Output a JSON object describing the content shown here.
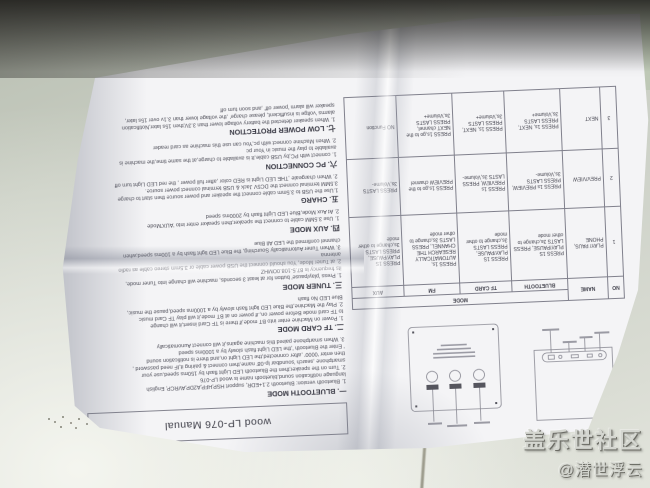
{
  "watermark": {
    "line1": "盖乐世社区",
    "line2": "@潜世浮云"
  },
  "manual": {
    "title": "wood LP-076 Manual",
    "sections": [
      {
        "heading": "一. BLUETOOTH MODE",
        "lines": [
          "1. Bluetooth version: Bluetooth 2.1+EDR, support HSP,HFP,A2DP,AVRCP, English",
          "language notification sound,bluetooth name is wood LP-076",
          "2. Turn on the speaker,then the Bluetooth LED Light flash by 150ms speed,use your",
          "smartphone ,search 'soundbar lp-08' name,then connect & pairing it,IF need password ,",
          "then enter '0000' ,after connected,the LED Light on,and there is notification sound",
          "' Enter the Bluetooth ',the LED Light flash slowly by a 1000ms speed",
          "3. When smartphone paired this machine agains,it will connect Aunomatically"
        ]
      },
      {
        "heading": "二. TF CARD MODE",
        "lines": [
          "1. Power on Machine enter into BT mode,if there is TF Card insert,it will change",
          "to TF card mode Before power on,.if power on at BT mode,it will play TF Card music",
          "2. Play the Machine,the Blue LED light flash slowly by a 1000ms speed,pause the music,",
          "Blue LED No flash"
        ]
      },
      {
        "heading": "三. TUNER MODE",
        "lines": [
          "1. Press 'play/pause' button for at least 3 seconds, machine will change into Tuner mode,",
          "its frequency is 87.5-108.0OMHZ",
          "2. at Tuner Mode, You should connect the USB power cable or 3.5mm stereo cable as radio",
          "antenna",
          "3. When Tuner Automatically Sourching, the Blue LED light flash by a 100ms speed,when",
          "channel confirmed the LED All Blue"
        ]
      },
      {
        "heading": "四. AUX MODE",
        "lines": [
          "1. Use 3.5MM cable to connect the speaker,then speaker enter into 'AUX'Mode",
          "2. At Aux Mode,Blue LED Light flash by 2000ms speed"
        ]
      },
      {
        "heading": "五. CHARG",
        "lines": [
          "1.Use the USB to 3.5mm cable connect the speaker and power source then start to charge",
          "3.5MM terminal connect the DC5V Jack & USB terminal connect power source.",
          "2. When chargeale ,THE LED Light is RED color ,after full power , the red LED Light turn off"
        ]
      },
      {
        "heading": "六. PC CONNECTION",
        "lines": [
          "1. connect with PC,by USB cable,It is available to charge,at the same time,the machine is",
          "available to play the music in Your pc",
          "2. When Machine connect with pc,You can use this machine as card reader"
        ]
      },
      {
        "heading": "七. LOW POWER PROTECTION",
        "lines": [
          "1. When speaker detected the battery voltage lower than 3.3V,then 15s later,Notification",
          "alarms 'voltge is insufficient, please charge' ,the voltage lower than 3.1v over 15s later,",
          "speaker will alarm 'power off' ,and soon turn off"
        ]
      }
    ],
    "table": {
      "mode_header": "MODE",
      "col_no": "NO",
      "col_name": "NAME",
      "mode_cols": [
        "BLUETOOTH",
        "TF CARD",
        "FM",
        "AUX"
      ],
      "rows": [
        {
          "no": "1",
          "name": "PLAY/ PAUS, PHONE",
          "cells": [
            "PRESS 1S PLAY/PAUSE, PRESS LASTS 3s,change to other mode",
            "PRESS 1S PLAY/PAUSE, PRESS LASTS 3s,change to other mode",
            "PRESS 1s, AUTOMATICALLY RESEARCH THE CHANNEL, PRESS LASTS 3s,change to other mode",
            "PRESS 1S PLAY/PAUSE, PRESS LASTS 3s,change to other mode"
          ]
        },
        {
          "no": "2",
          "name": "PREV/VIEW",
          "cells": [
            "PRESS 1s PREVIEW, PRESS LASTS 3s,Volume-",
            "PRESS 1s PREVIEW, PRESS LASTS 3s,Volume-",
            "PRESS 1s,go to the PREVIEW channel",
            "PRESS LASTS 3s,Volume-"
          ]
        },
        {
          "no": "3",
          "name": "NEXT",
          "cells": [
            "PRESS 1s, NEXT, PRESS LASTS 3s,Volume+",
            "PRESS 1s, NEXT, PRESS LASTS 3s,Volume+",
            "PRESS 1s,go to the NEXT channel, PRESS LASTS 3s,Volume+",
            "NO Function"
          ]
        }
      ]
    }
  }
}
